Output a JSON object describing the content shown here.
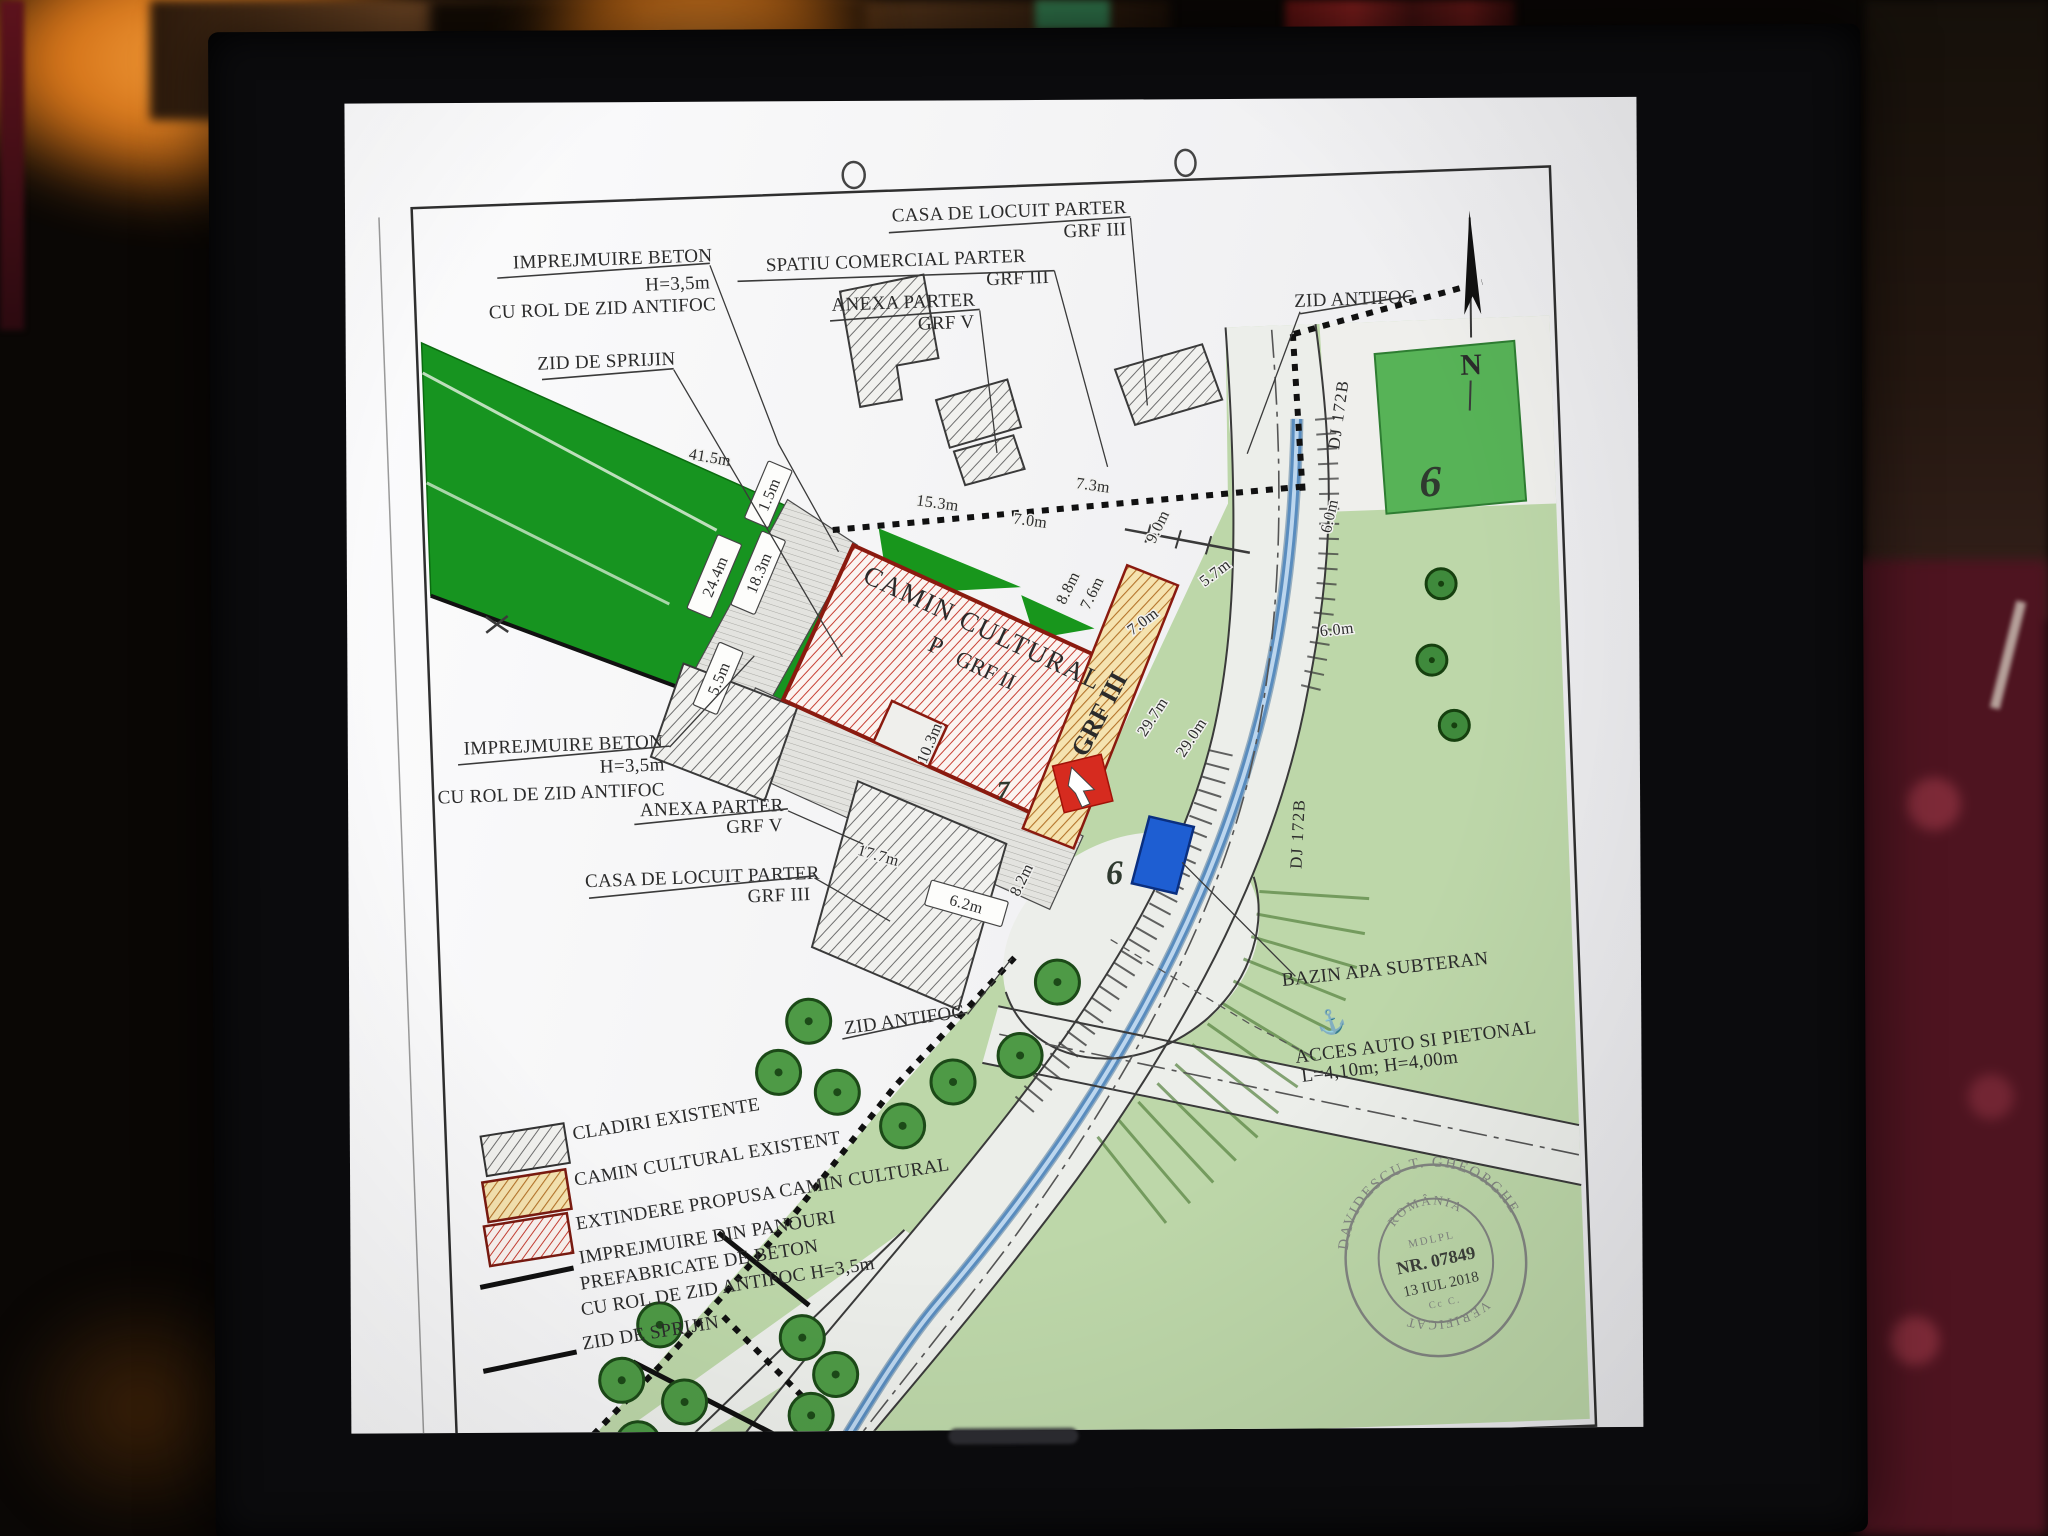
{
  "plan": {
    "callouts": {
      "imprejmuire_top": {
        "l1": "IMPREJMUIRE BETON",
        "l2": "H=3,5m",
        "l3": "CU ROL DE ZID ANTIFOC"
      },
      "zid_sprijin_top": {
        "l1": "ZID DE SPRIJIN"
      },
      "casa_top": {
        "l1": "CASA DE LOCUIT PARTER",
        "l2": "GRF III"
      },
      "spatiu": {
        "l1": "SPATIU COMERCIAL PARTER",
        "l2": "GRF III"
      },
      "anexa_top": {
        "l1": "ANEXA PARTER",
        "l2": "GRF V"
      },
      "zid_antifoc_top": {
        "l1": "ZID ANTIFOC"
      },
      "imprejmuire_left": {
        "l1": "IMPREJMUIRE BETON",
        "l2": "H=3,5m",
        "l3": "CU ROL DE ZID ANTIFOC"
      },
      "anexa_bottom": {
        "l1": "ANEXA PARTER",
        "l2": "GRF V"
      },
      "casa_bottom": {
        "l1": "CASA DE LOCUIT PARTER",
        "l2": "GRF III"
      },
      "zid_antifoc_bottom": {
        "l1": "ZID ANTIFOC"
      },
      "bazin": {
        "l1": "BAZIN APA SUBTERAN"
      },
      "acces": {
        "l1": "ACCES AUTO SI PIETONAL",
        "l2": "L=4,10m; H=4,00m"
      }
    },
    "building": {
      "name": "CAMIN CULTURAL",
      "level": "P",
      "grf": "GRF II",
      "grf_existing": "GRF III"
    },
    "ro<!-- -->ads": {
      "dj1": "DJ 172B",
      "dj2": "DJ 172B"
    },
    "north": "N",
    "plots": {
      "p6_field": "6",
      "p6_road": "6",
      "p7": "7"
    },
    "dims": {
      "d41_5": "41.5m",
      "d24_4": "24.4m",
      "d18_3": "18.3m",
      "d5_5": "5.5m",
      "d1_5": "1.5m",
      "d15_3": "15.3m",
      "d7_0a": "7.0m",
      "d7_3": "7.3m",
      "d9_0": "9.0m",
      "d8_8": "8.8m",
      "d7_6": "7.6m",
      "d7_0b": "7.0m",
      "d5_7": "5.7m",
      "d6_0a": "6.0m",
      "d6_0b": "6.0m",
      "d29_7": "29.7m",
      "d29_0": "29.0m",
      "d10_3": "10.3m",
      "d17_7": "17.7m",
      "d6_2": "6.2m",
      "d8_2": "8.2m"
    },
    "legend": {
      "items": [
        {
          "label": "CLADIRI EXISTENTE"
        },
        {
          "label": "CAMIN CULTURAL EXISTENT"
        },
        {
          "label": "EXTINDERE PROPUSA CAMIN CULTURAL"
        },
        {
          "lines": [
            "IMPREJMUIRE DIN PANOURI",
            "PREFABRICATE DE BETON",
            "CU ROL DE ZID ANTIFOC H=3,5m"
          ]
        },
        {
          "label": "ZID DE SPRIJIN"
        }
      ]
    },
    "stamp": {
      "arc_top": "DAVIDESCU T. GHEORGHE",
      "country": "ROMÂNIA",
      "org": "MDLPL",
      "number": "NR. 07849",
      "date": "13 IUL 2018",
      "small": "Cc C.",
      "arc_bottom": "VERIFICAT"
    },
    "symbols": {
      "anchor": "⚓"
    },
    "colors": {
      "field_green": "#179420",
      "light_green": "#bdd7a9",
      "extension_red": "#d62b1f",
      "car_blue": "#1e5ed2"
    }
  }
}
